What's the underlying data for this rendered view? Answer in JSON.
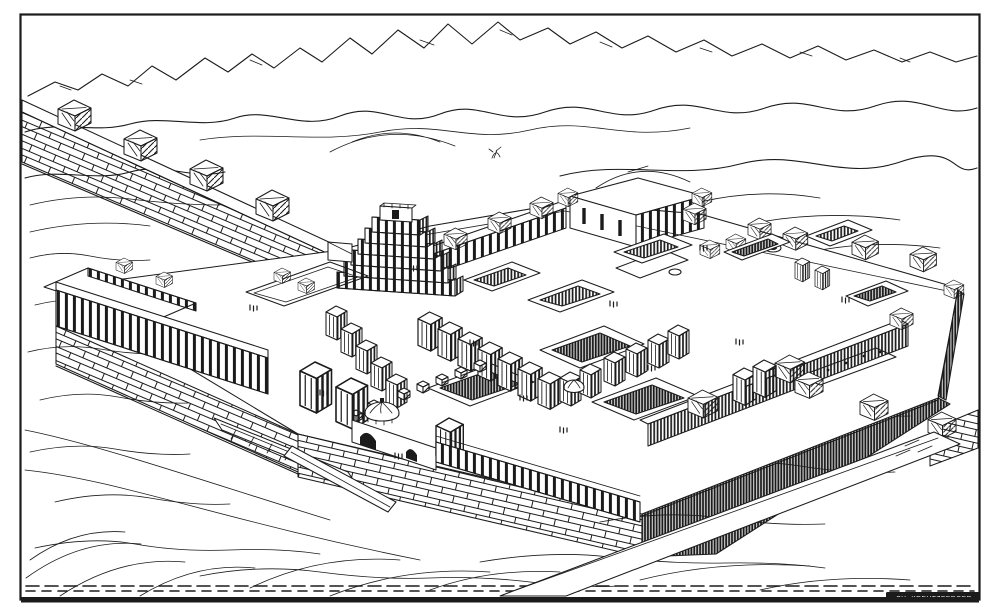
{
  "figure": {
    "signature": "CH. KREUTZBERGER",
    "palette": {
      "ink": "#1b1b1b",
      "paper": "#ffffff"
    },
    "elements": [
      "mountain-ranges",
      "desert-plain",
      "city-wall-with-towers",
      "ziggurat",
      "palace-terrace",
      "grand-courtyard",
      "sunken-courts",
      "domed-gate",
      "colonnade-facade",
      "access-ramps",
      "engraver-signature"
    ]
  }
}
